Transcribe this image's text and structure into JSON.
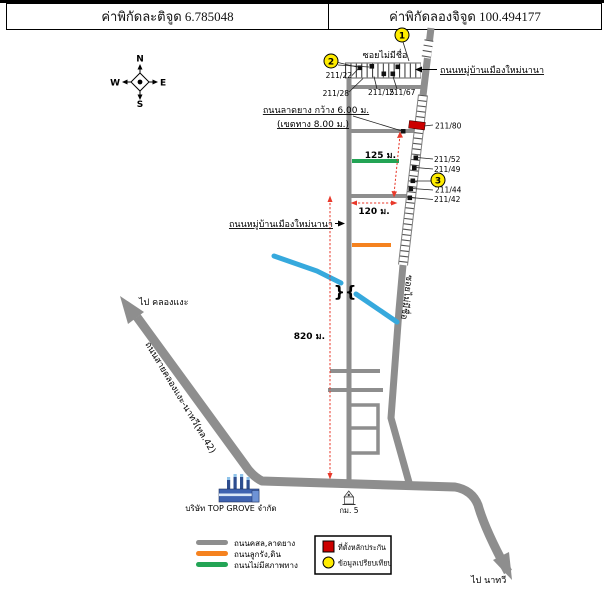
{
  "header": {
    "latitude": "ค่าพิกัดละติจูด 6.785048",
    "longitude": "ค่าพิกัดลองจิจูด 100.494177"
  },
  "compass": {
    "north": "N",
    "south": "S",
    "east": "E",
    "west": "W"
  },
  "roads": {
    "soi_top": "ซอยไม่มีชื่อ",
    "soi_side": "ซอยไม่มีชื่อ",
    "village_road_right": "ถนนหมู่บ้านเมืองใหม่นานา",
    "village_road_left": "ถนนหมู่บ้านเมืองใหม่นานา",
    "spec_line1": "ถนนลาดยาง กว้าง 6.00 ม.",
    "spec_line2": "(เขตทาง 8.00 ม.)",
    "highway": "ถนนสายคลองแงะ-นาทวี(ทล.42)",
    "to_northwest": "ไป คลองแงะ",
    "to_southeast": "ไป นาทวี"
  },
  "distances": {
    "d125": "125 ม.",
    "d120": "120 ม.",
    "d820": "820 ม."
  },
  "houses": [
    "211/22",
    "211/28",
    "211/15",
    "211/67",
    "211/80",
    "211/52",
    "211/49",
    "211/44",
    "211/42"
  ],
  "markers": [
    "1",
    "2",
    "3"
  ],
  "places": {
    "company": "บริษัท TOP GROVE จำกัด",
    "km_post": "กม. 5"
  },
  "bridge_symbol": "}{",
  "legend": {
    "road_types": [
      {
        "label": "ถนนคสล,ลาดยาง",
        "color": "#8e8e8e"
      },
      {
        "label": "ถนนลูกรัง,ดิน",
        "color": "#f5821f"
      },
      {
        "label": "ถนนไม่มีสภาพทาง",
        "color": "#23a455"
      }
    ],
    "collateral": "ที่ตั้งหลักประกัน",
    "comparison": "ข้อมูลเปรียบเทียบ"
  },
  "colors": {
    "road": "#8e8e8e",
    "stream": "#36a9dd",
    "dimension": "#e8392b",
    "collateral": "#cc0000",
    "marker_fill": "#ffec00",
    "green_road": "#23a455",
    "orange_road": "#f5821f"
  }
}
